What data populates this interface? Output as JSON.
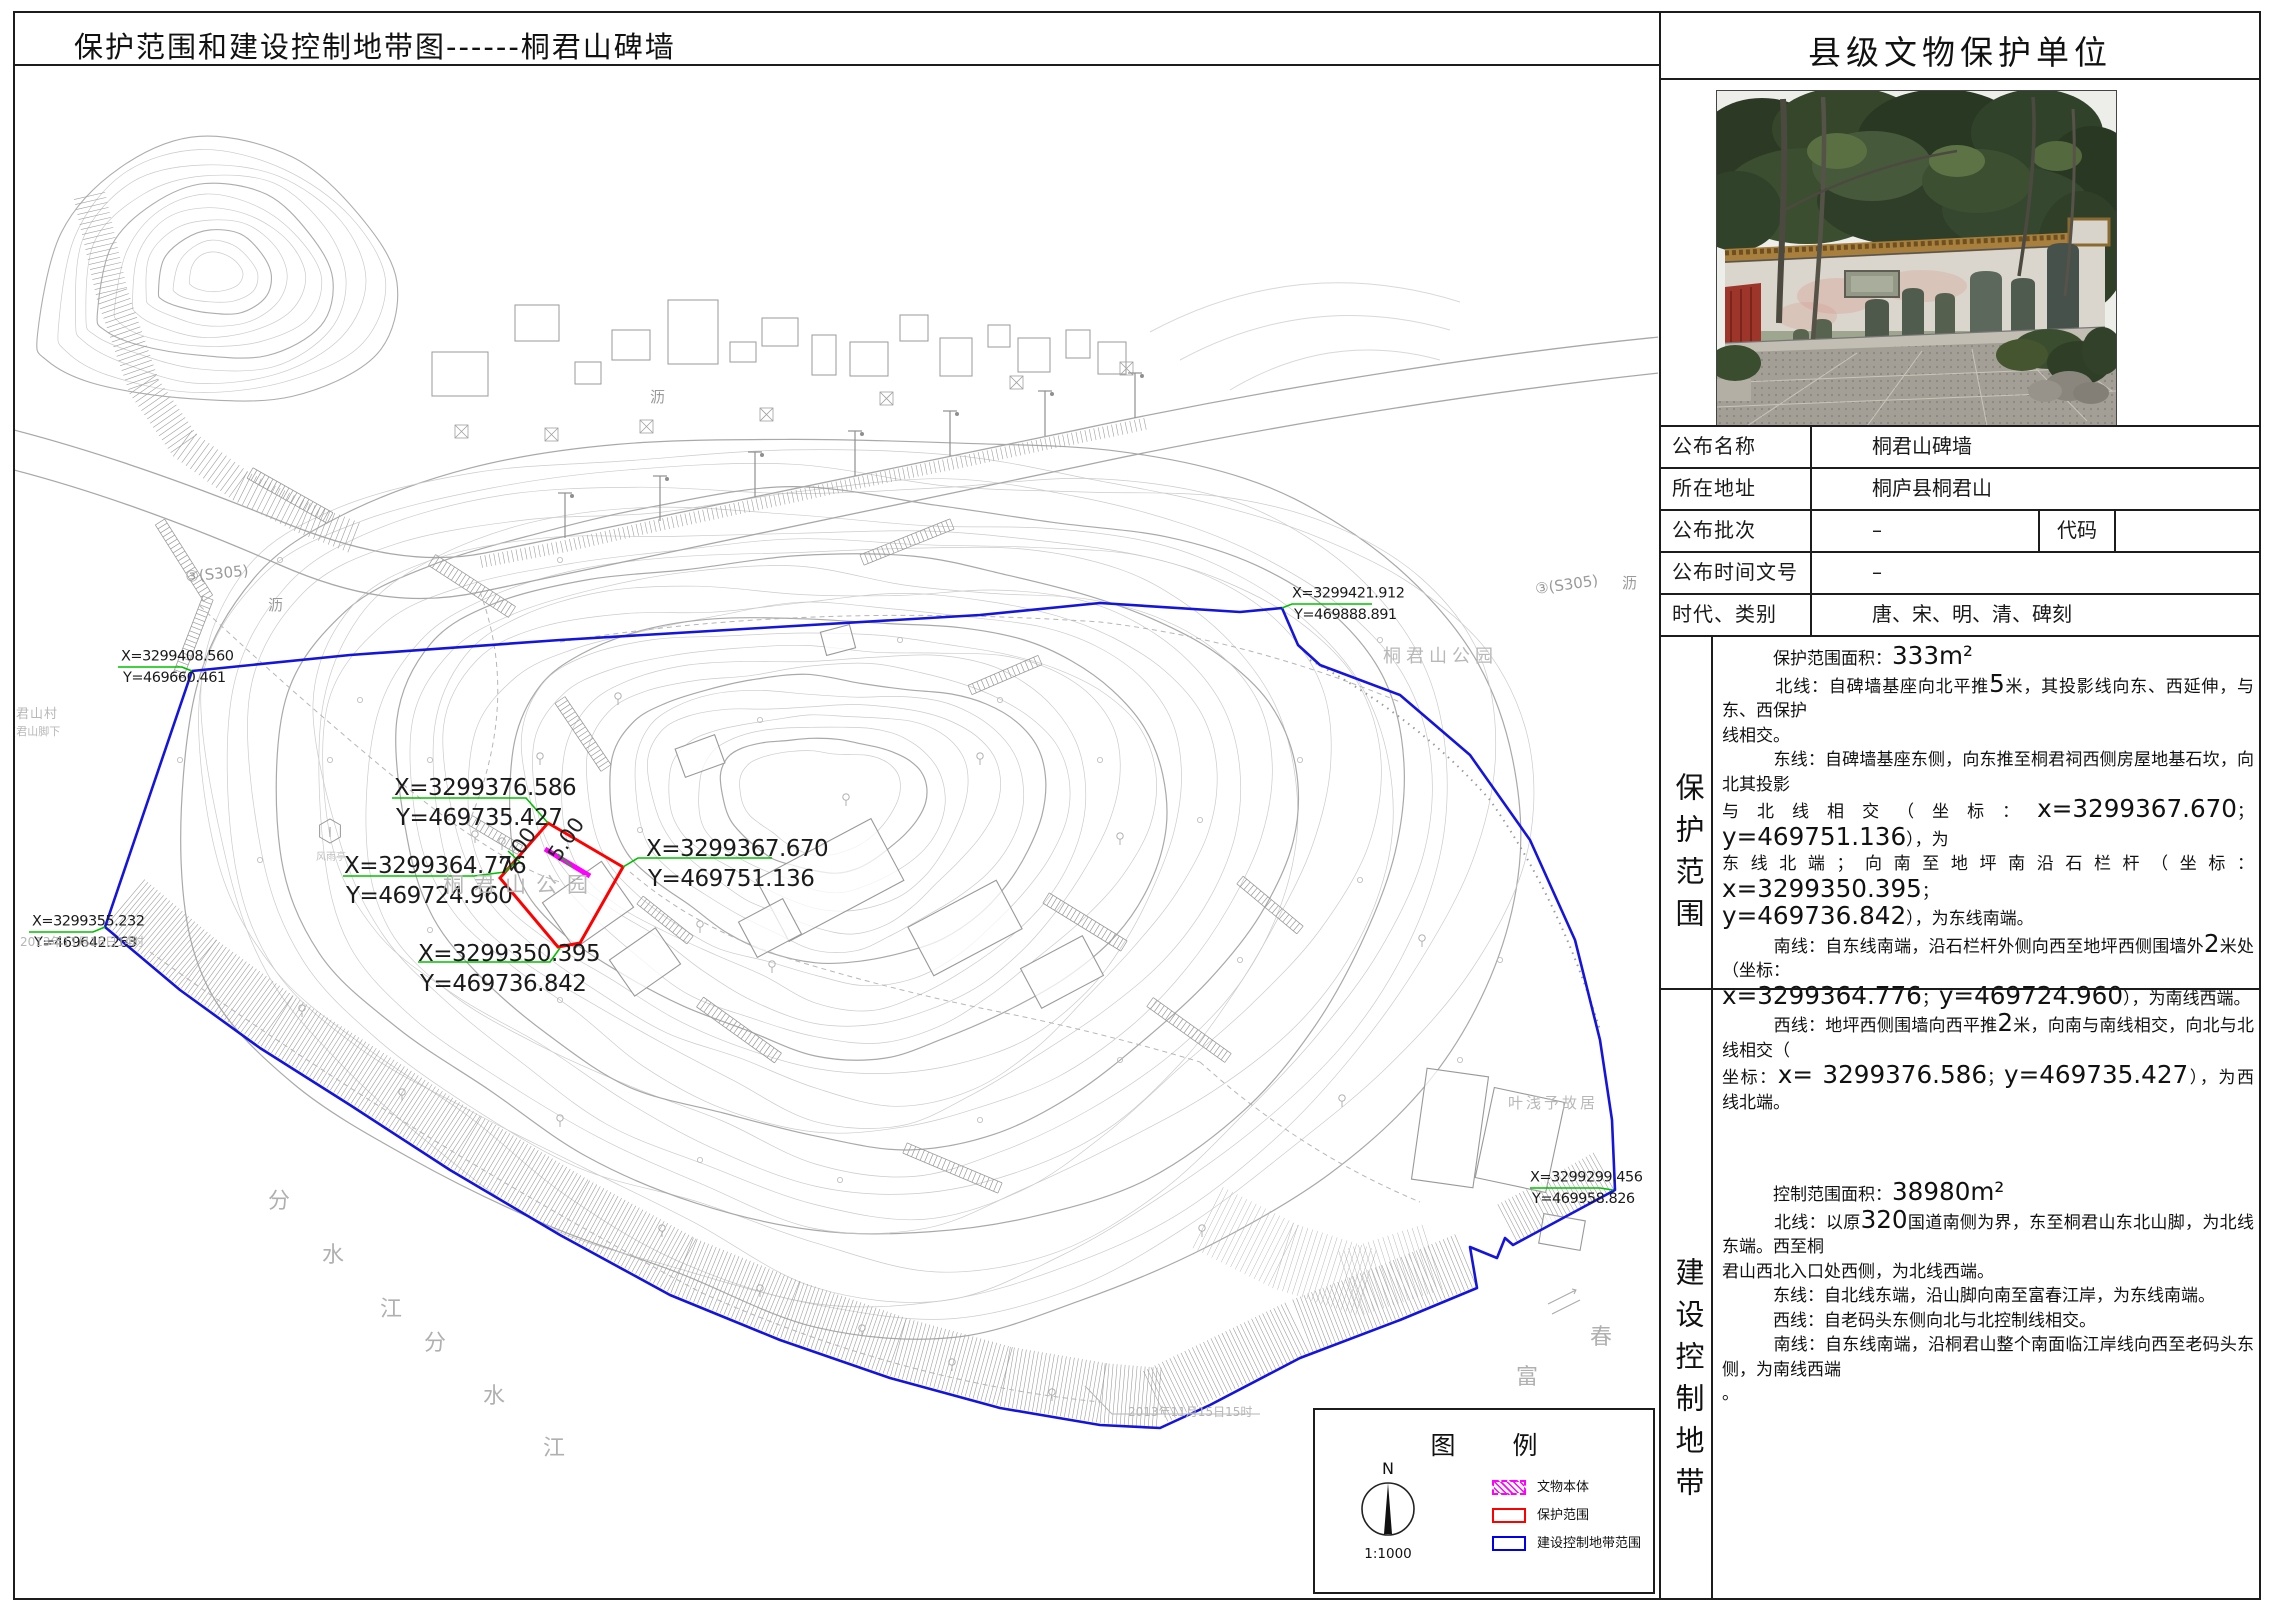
{
  "page": {
    "title_left": "保护范围和建设控制地带图------桐君山碑墙",
    "title_right": "县级文物保护单位"
  },
  "info_table": {
    "rows": [
      {
        "label": "公布名称",
        "value": "桐君山碑墙"
      },
      {
        "label": "所在地址",
        "value": "桐庐县桐君山"
      },
      {
        "label": "公布批次",
        "value": "–",
        "label2": "代码",
        "value2": ""
      },
      {
        "label": "公布时间文号",
        "value": "–"
      },
      {
        "label": "时代、类别",
        "value": "唐、宋、明、清、碑刻"
      }
    ]
  },
  "protection_scope": {
    "side_label": "保护范围",
    "lines": [
      "　　　保护范围面积：333m²",
      "　　　北线：自碑墙基座向北平推5米，其投影线向东、西延伸，与东、西保护",
      "线相交。",
      "　　　东线：自碑墙基座东侧，向东推至桐君祠西侧房屋地基石坎，向北其投影",
      "与北线相交（坐标：x=3299367.670；y=469751.136），为",
      "东线北端；向南至地坪南沿石栏杆（坐标：x=3299350.395；",
      "y=469736.842），为东线南端。",
      "　　　南线：自东线南端，沿石栏杆外侧向西至地坪西侧围墙外2米处（坐标：",
      "x=3299364.776；y=469724.960），为南线西端。",
      "　　　西线：地坪西侧围墙向西平推2米，向南与南线相交，向北与北线相交（",
      "坐标：x= 3299376.586；y=469735.427），为西线北端。"
    ]
  },
  "control_zone": {
    "side_label": "建设控制地带",
    "lines": [
      "　　　控制范围面积：38980m²",
      "　　　北线：以原320国道南侧为界，东至桐君山东北山脚，为北线东端。西至桐",
      "君山西北入口处西侧，为北线西端。",
      "　　　东线：自北线东端，沿山脚向南至富春江岸，为东线南端。",
      "　　　西线：自老码头东侧向北与北控制线相交。",
      "　　　南线：自东线南端，沿桐君山整个南面临江岸线向西至老码头东侧，为南线西端",
      "。"
    ]
  },
  "legend": {
    "title": "图　例",
    "compass_n": "N",
    "scale": "1:1000",
    "items": [
      {
        "label": "文物本体",
        "color": "#ff00ff",
        "style": "hatch"
      },
      {
        "label": "保护范围",
        "color": "#ff0000",
        "style": "solid"
      },
      {
        "label": "建设控制地带范围",
        "color": "#0000ee",
        "style": "solid"
      }
    ]
  },
  "colors": {
    "boundary_blue": "#1414dd",
    "protection_red": "#ff0000",
    "monument_magenta": "#ff00ff",
    "leader_green": "#00c000"
  },
  "map": {
    "coord_labels_small": [
      {
        "l1": "X=3299408.560",
        "l2": "Y=469660.461",
        "x": 121,
        "y": 646,
        "size": 14.5,
        "green": [
          [
            118,
            667
          ],
          [
            182,
            667
          ],
          [
            192,
            671
          ]
        ]
      },
      {
        "l1": "X=3299355.232",
        "l2": "Y=469642.263",
        "x": 32,
        "y": 911,
        "size": 14.5,
        "green": [
          [
            29,
            932
          ],
          [
            93,
            932
          ],
          [
            105,
            927
          ]
        ]
      },
      {
        "l1": "X=3299421.912",
        "l2": "Y=469888.891",
        "x": 1292,
        "y": 583,
        "size": 14.5,
        "green": [
          [
            1282,
            608
          ],
          [
            1292,
            604
          ],
          [
            1372,
            604
          ]
        ]
      },
      {
        "l1": "X=3299299.456",
        "l2": "Y=469958.826",
        "x": 1530,
        "y": 1167,
        "size": 14.5,
        "green": [
          [
            1530,
            1188
          ],
          [
            1600,
            1188
          ],
          [
            1613,
            1190
          ]
        ]
      }
    ],
    "coord_labels_big": [
      {
        "l1": "X=3299376.586",
        "l2": "Y=469735.427",
        "x": 394,
        "y": 772,
        "size": 23,
        "green": [
          [
            392,
            798
          ],
          [
            526,
            798
          ],
          [
            548,
            823
          ]
        ]
      },
      {
        "l1": "X=3299364.776",
        "l2": "Y=469724.960",
        "x": 344,
        "y": 850,
        "size": 23,
        "green": [
          [
            343,
            876
          ],
          [
            474,
            876
          ],
          [
            505,
            872
          ],
          [
            516,
            861
          ]
        ]
      },
      {
        "l1": "X=3299367.670",
        "l2": "Y=469751.136",
        "x": 646,
        "y": 833,
        "size": 23,
        "green": [
          [
            623,
            867
          ],
          [
            638,
            858
          ],
          [
            772,
            858
          ]
        ]
      },
      {
        "l1": "X=3299350.395",
        "l2": "Y=469736.842",
        "x": 418,
        "y": 938,
        "size": 23,
        "green": [
          [
            418,
            962
          ],
          [
            550,
            962
          ],
          [
            560,
            948
          ]
        ]
      }
    ],
    "dim_labels": [
      {
        "text": "2.00",
        "x": 524,
        "y": 853,
        "rot": -56,
        "size": 21
      },
      {
        "text": "5.00",
        "x": 572,
        "y": 843,
        "rot": -56,
        "size": 21
      }
    ],
    "place_labels": [
      {
        "text": "桐君山公园",
        "x": 443,
        "y": 892,
        "size": 21,
        "ls": 10,
        "color": "#b8b8b8"
      },
      {
        "text": "桐君山公园",
        "x": 1383,
        "y": 662,
        "size": 18,
        "ls": 5,
        "color": "#b8b8b8"
      },
      {
        "text": "叶浅予故居",
        "x": 1508,
        "y": 1108,
        "size": 15,
        "ls": 3,
        "color": "#b8b8b8"
      },
      {
        "text": "君山村",
        "x": 16,
        "y": 718,
        "size": 13,
        "ls": 1,
        "color": "#b8b8b8"
      },
      {
        "text": "(君山脚下",
        "x": 12,
        "y": 735,
        "size": 11,
        "ls": 0,
        "color": "#b8b8b8"
      },
      {
        "text": "风雨亭",
        "x": 316,
        "y": 860,
        "size": 10,
        "ls": 0,
        "color": "#c0c0c0"
      },
      {
        "text": "分",
        "x": 268,
        "y": 1208,
        "size": 22,
        "ls": 0,
        "color": "#b0b0b0"
      },
      {
        "text": "水",
        "x": 322,
        "y": 1262,
        "size": 22,
        "ls": 0,
        "color": "#b0b0b0"
      },
      {
        "text": "江",
        "x": 380,
        "y": 1316,
        "size": 22,
        "ls": 0,
        "color": "#b0b0b0"
      },
      {
        "text": "分",
        "x": 424,
        "y": 1350,
        "size": 22,
        "ls": 0,
        "color": "#b0b0b0"
      },
      {
        "text": "水",
        "x": 483,
        "y": 1403,
        "size": 22,
        "ls": 0,
        "color": "#b0b0b0"
      },
      {
        "text": "江",
        "x": 543,
        "y": 1455,
        "size": 22,
        "ls": 0,
        "color": "#b0b0b0"
      },
      {
        "text": "富",
        "x": 1516,
        "y": 1384,
        "size": 22,
        "ls": 0,
        "color": "#b0b0b0"
      },
      {
        "text": "春",
        "x": 1590,
        "y": 1344,
        "size": 22,
        "ls": 0,
        "color": "#b0b0b0"
      }
    ],
    "road_labels": [
      {
        "text": "③(S305)",
        "x": 186,
        "y": 582,
        "size": 15,
        "rot": -6,
        "color": "#9a9a9a"
      },
      {
        "text": "沥",
        "x": 268,
        "y": 610,
        "size": 15,
        "rot": 0,
        "color": "#9a9a9a"
      },
      {
        "text": "沥",
        "x": 650,
        "y": 402,
        "size": 15,
        "rot": 0,
        "color": "#9a9a9a"
      },
      {
        "text": "③(S305)",
        "x": 1536,
        "y": 594,
        "size": 15,
        "rot": -8,
        "color": "#9a9a9a"
      },
      {
        "text": "沥",
        "x": 1622,
        "y": 588,
        "size": 15,
        "rot": 0,
        "color": "#9a9a9a"
      }
    ],
    "date_labels": [
      {
        "text": "2013年11月16日14时",
        "x": 20,
        "y": 946,
        "size": 12,
        "color": "#b5b5b5"
      },
      {
        "text": "2013年11月15日15时",
        "x": 1128,
        "y": 1416,
        "size": 12,
        "color": "#b5b5b5"
      }
    ]
  }
}
